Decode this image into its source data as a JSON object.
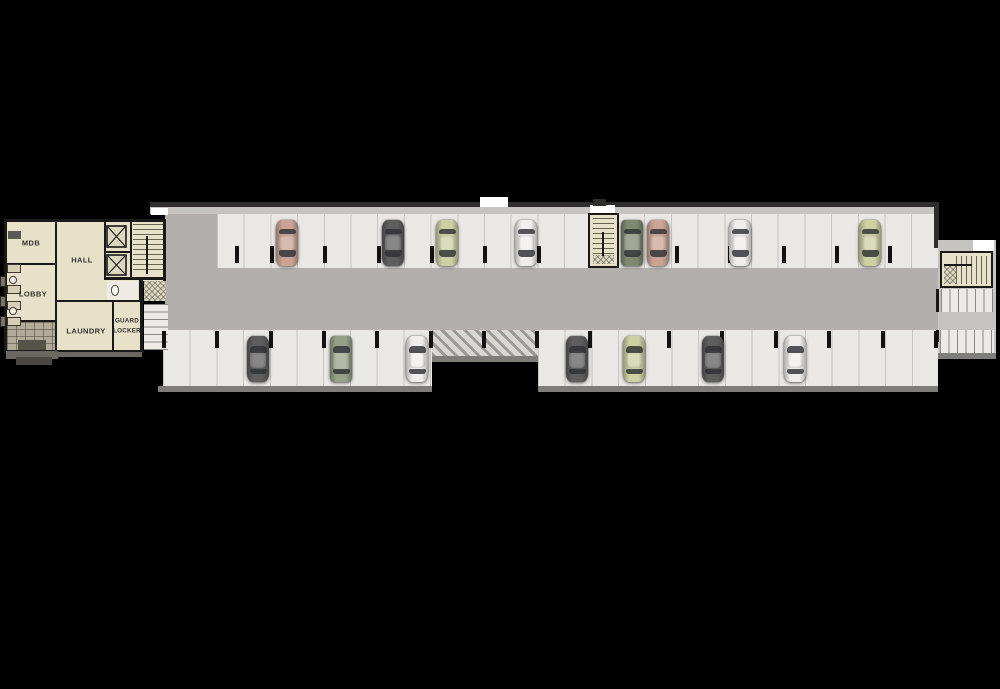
{
  "canvas": {
    "width": 1000,
    "height": 689,
    "background": "#000000"
  },
  "rooms": {
    "mdb": {
      "label": "MDB"
    },
    "hall": {
      "label": "HALL"
    },
    "lobby": {
      "label": "LOBBY"
    },
    "laundry": {
      "label": "LAUNDRY"
    },
    "guard_locker": {
      "line1": "GUARD",
      "line2": "LOCKER"
    }
  },
  "colors": {
    "background": "#000000",
    "stall": "#eae8e5",
    "aisle": "#b2afad",
    "walkway": "#c6c4c1",
    "wall": "#1a1918",
    "room": "#e7e1ca",
    "curb": "#7f7d7a",
    "column": "#121212",
    "white": "#ffffff",
    "label": "#33312d",
    "cars": {
      "salmon": "#cba395",
      "dark_gray": "#5e5e5e",
      "pale_green": "#ccd0a2",
      "white": "#efeeec",
      "suv_green": "#7f8970",
      "van_green": "#97a188",
      "glass": "#2e3134"
    }
  },
  "parking": {
    "stall_pitch_px": 26.7,
    "rows": {
      "top": {
        "y": 220
      },
      "bottom": {
        "y": 336
      }
    },
    "columns": {
      "top_x": [
        235,
        270,
        323,
        377,
        430,
        483,
        537,
        675,
        728,
        782,
        835,
        888
      ],
      "bottom_x": [
        162,
        215,
        269,
        322,
        375,
        429,
        482,
        535,
        588,
        667,
        720,
        774,
        827,
        881,
        934
      ]
    },
    "cars": [
      {
        "row": "top",
        "x": 276,
        "color": "salmon",
        "body": "sedan"
      },
      {
        "row": "top",
        "x": 382,
        "color": "dark_gray",
        "body": "sedan"
      },
      {
        "row": "top",
        "x": 436,
        "color": "pale_green",
        "body": "sedan"
      },
      {
        "row": "top",
        "x": 515,
        "color": "white",
        "body": "sedan"
      },
      {
        "row": "top",
        "x": 621,
        "color": "suv_green",
        "body": "suv"
      },
      {
        "row": "top",
        "x": 647,
        "color": "salmon",
        "body": "sedan"
      },
      {
        "row": "top",
        "x": 729,
        "color": "white",
        "body": "sedan"
      },
      {
        "row": "top",
        "x": 859,
        "color": "pale_green",
        "body": "sedan"
      },
      {
        "row": "bottom",
        "x": 247,
        "color": "dark_gray",
        "body": "sedan"
      },
      {
        "row": "bottom",
        "x": 330,
        "color": "van_green",
        "body": "suv"
      },
      {
        "row": "bottom",
        "x": 406,
        "color": "white",
        "body": "sedan"
      },
      {
        "row": "bottom",
        "x": 566,
        "color": "dark_gray",
        "body": "sedan"
      },
      {
        "row": "bottom",
        "x": 623,
        "color": "pale_green",
        "body": "sedan"
      },
      {
        "row": "bottom",
        "x": 702,
        "color": "dark_gray",
        "body": "sedan"
      },
      {
        "row": "bottom",
        "x": 784,
        "color": "white",
        "body": "sedan"
      }
    ]
  }
}
